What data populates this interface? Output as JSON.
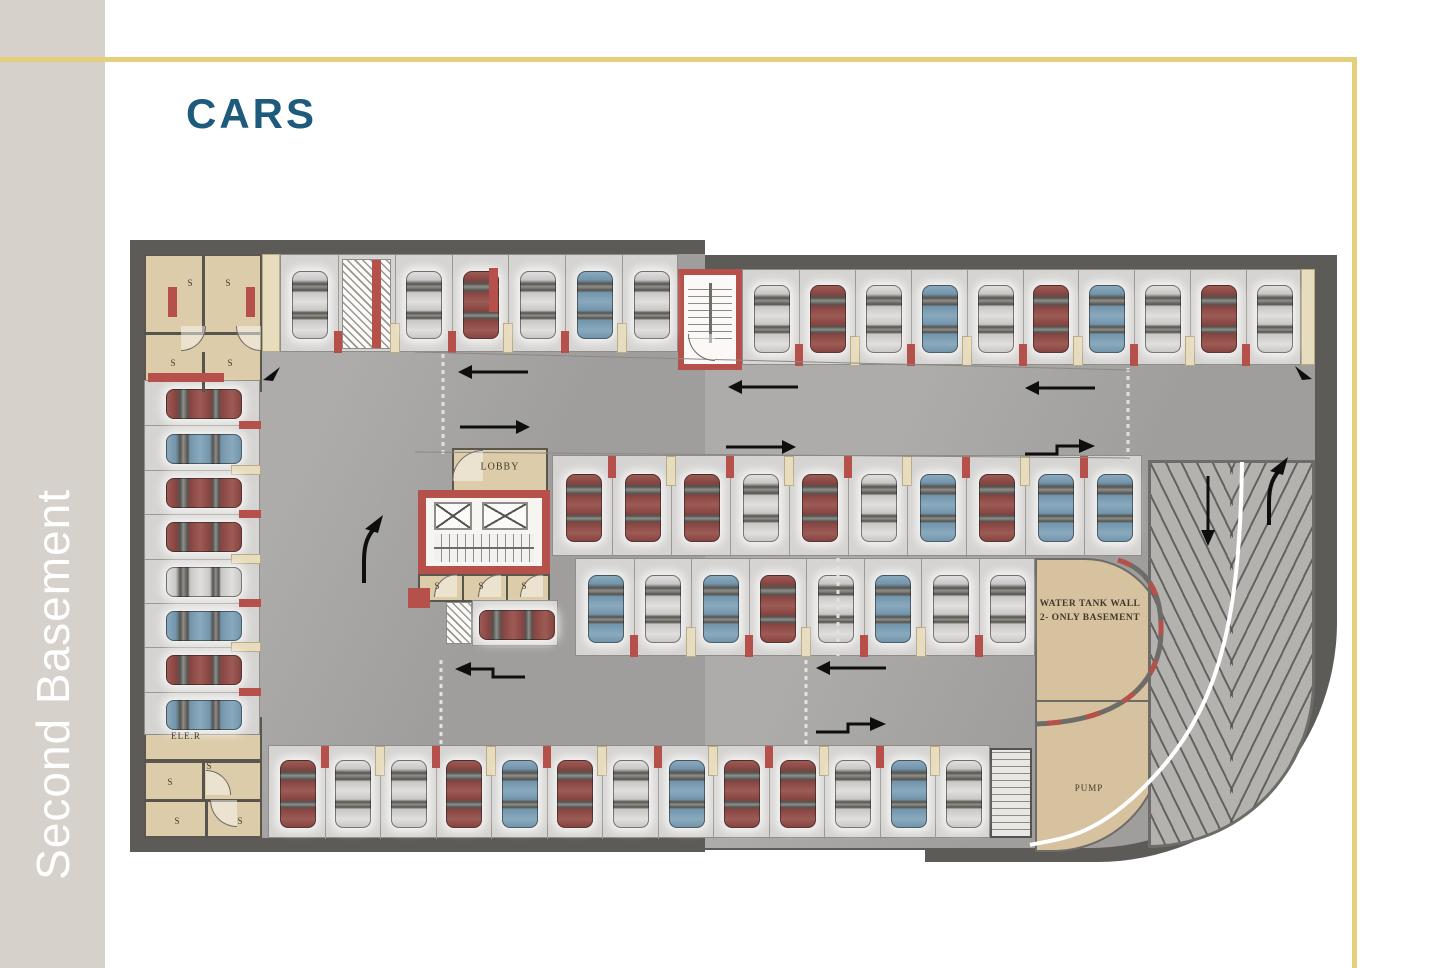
{
  "page": {
    "title": "CARS",
    "sidebar_label": "Second Basement",
    "accent_yellow": "#e4cf7d",
    "title_color": "#1d5a7c"
  },
  "plan": {
    "labels": {
      "lobby": "LOBBY",
      "water_tank_line1": "WATER TANK WALL",
      "water_tank_line2": "2- ONLY BASEMENT",
      "pump": "PUMP",
      "elevator_room": "ELE.R",
      "storage": "S"
    },
    "colors": {
      "wall": "#5d5b58",
      "floor": "#a8a7a5",
      "stall": "#d5d4d2",
      "beige": "#ddccaa",
      "tan": "#d6c29e",
      "red": "#b5504b",
      "accent": "#e4cf7d",
      "title_color": "#1d5a7c"
    },
    "car_colors": {
      "maroon": {
        "base": "#874441",
        "light": "#9d5b55"
      },
      "silver": {
        "base": "#c8c7c5",
        "light": "#e0dfdd"
      },
      "blue": {
        "base": "#7295ac",
        "light": "#8aa9bd"
      }
    },
    "rows": [
      {
        "name": "north-west-parking-row",
        "x": 280,
        "y": 254,
        "w": 398,
        "h": 98,
        "orient": "v",
        "lane": "bottom",
        "slots": [
          "silver",
          "hatch",
          "silver",
          "maroon",
          "silver",
          "blue",
          "silver"
        ]
      },
      {
        "name": "north-east-parking-row",
        "x": 742,
        "y": 269,
        "w": 559,
        "h": 96,
        "orient": "v",
        "lane": "bottom",
        "slots": [
          "silver",
          "maroon",
          "silver",
          "blue",
          "silver",
          "maroon",
          "blue",
          "silver",
          "maroon",
          "silver"
        ]
      },
      {
        "name": "west-parking-column",
        "x": 144,
        "y": 380,
        "w": 116,
        "h": 355,
        "orient": "h",
        "lane": "right",
        "slots": [
          "maroon",
          "blue",
          "maroon",
          "maroon",
          "silver",
          "blue",
          "maroon",
          "blue"
        ]
      },
      {
        "name": "center-north-parking-row",
        "x": 552,
        "y": 455,
        "w": 590,
        "h": 101,
        "orient": "v",
        "lane": "top",
        "slots": [
          "maroon",
          "maroon",
          "maroon",
          "silver",
          "maroon",
          "silver",
          "blue",
          "maroon",
          "blue",
          "blue"
        ]
      },
      {
        "name": "center-south-parking-row",
        "x": 575,
        "y": 558,
        "w": 460,
        "h": 98,
        "orient": "v",
        "lane": "bottom",
        "slots": [
          "blue",
          "silver",
          "blue",
          "maroon",
          "silver",
          "blue",
          "silver",
          "silver"
        ]
      },
      {
        "name": "south-parking-row",
        "x": 268,
        "y": 745,
        "w": 722,
        "h": 93,
        "orient": "v",
        "lane": "top",
        "slots": [
          "maroon",
          "silver",
          "silver",
          "maroon",
          "blue",
          "maroon",
          "silver",
          "blue",
          "maroon",
          "maroon",
          "silver",
          "blue",
          "silver"
        ]
      },
      {
        "name": "lobby-side-stall",
        "x": 472,
        "y": 600,
        "w": 86,
        "h": 46,
        "orient": "h",
        "lane": "left",
        "slots": [
          "maroon"
        ]
      }
    ],
    "arrows": [
      {
        "x": 494,
        "y": 372,
        "dir": "left"
      },
      {
        "x": 494,
        "y": 427,
        "dir": "right"
      },
      {
        "x": 764,
        "y": 387,
        "dir": "left"
      },
      {
        "x": 760,
        "y": 447,
        "dir": "right"
      },
      {
        "x": 1061,
        "y": 388,
        "dir": "left"
      },
      {
        "x": 1059,
        "y": 446,
        "dir": "right-bent"
      },
      {
        "x": 491,
        "y": 669,
        "dir": "left-bent"
      },
      {
        "x": 852,
        "y": 668,
        "dir": "left"
      },
      {
        "x": 850,
        "y": 724,
        "dir": "right-bent"
      },
      {
        "x": 371,
        "y": 550,
        "dir": "up-curve"
      },
      {
        "x": 1208,
        "y": 510,
        "dir": "down"
      },
      {
        "x": 1276,
        "y": 492,
        "dir": "up-curve"
      },
      {
        "x": 272,
        "y": 374,
        "dir": "corner-sw"
      },
      {
        "x": 1303,
        "y": 373,
        "dir": "corner-se"
      }
    ],
    "s_labels": [
      {
        "x": 190,
        "y": 283
      },
      {
        "x": 228,
        "y": 283
      },
      {
        "x": 173,
        "y": 363
      },
      {
        "x": 230,
        "y": 363
      },
      {
        "x": 437,
        "y": 586
      },
      {
        "x": 481,
        "y": 586
      },
      {
        "x": 524,
        "y": 586
      },
      {
        "x": 209,
        "y": 766
      },
      {
        "x": 170,
        "y": 782
      },
      {
        "x": 177,
        "y": 821
      },
      {
        "x": 240,
        "y": 821
      }
    ],
    "red_bars": [
      {
        "x": 168,
        "y": 287,
        "w": 9,
        "h": 30
      },
      {
        "x": 246,
        "y": 287,
        "w": 9,
        "h": 30
      },
      {
        "x": 148,
        "y": 373,
        "w": 76,
        "h": 9
      },
      {
        "x": 372,
        "y": 260,
        "w": 9,
        "h": 88
      },
      {
        "x": 489,
        "y": 268,
        "w": 9,
        "h": 44
      }
    ],
    "arcs": [
      {
        "x": 181,
        "y": 326,
        "r": 24,
        "rot": 270
      },
      {
        "x": 236,
        "y": 326,
        "r": 24,
        "rot": 0
      },
      {
        "x": 452,
        "y": 450,
        "r": 30,
        "rot": 90
      },
      {
        "x": 688,
        "y": 334,
        "r": 26,
        "rot": 0
      },
      {
        "x": 434,
        "y": 574,
        "r": 22,
        "rot": 90
      },
      {
        "x": 478,
        "y": 574,
        "r": 22,
        "rot": 90
      },
      {
        "x": 520,
        "y": 574,
        "r": 22,
        "rot": 90
      },
      {
        "x": 206,
        "y": 770,
        "r": 24,
        "rot": 180
      },
      {
        "x": 210,
        "y": 800,
        "r": 26,
        "rot": 0
      }
    ]
  }
}
